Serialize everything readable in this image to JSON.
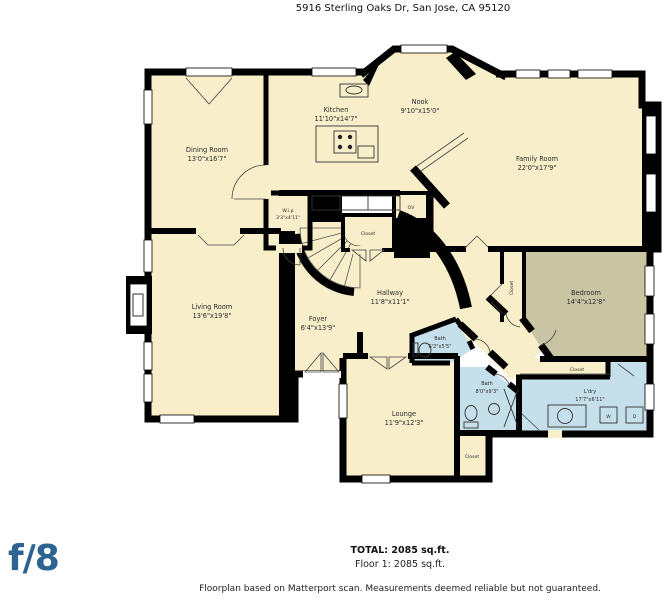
{
  "title": "5916 Sterling Oaks Dr, San Jose, CA 95120",
  "logo_text": "f/8",
  "summary": {
    "total": "TOTAL: 2085 sq.ft.",
    "floor": "Floor 1: 2085 sq.ft."
  },
  "disclaimer": "Floorplan based on Matterport scan. Measurements deemed reliable but not guaranteed.",
  "colors": {
    "room_fill": "#f8efca",
    "bedroom_fill": "#c9c4a4",
    "bath_fill": "#c6e0eb",
    "wall": "#000000",
    "logo_blue": "#2d6390"
  },
  "rooms": {
    "kitchen": {
      "name": "Kitchen",
      "dims": "11'10\"x14'7\""
    },
    "nook": {
      "name": "Nook",
      "dims": "9'10\"x15'0\""
    },
    "dining_room": {
      "name": "Dining Room",
      "dims": "13'0\"x16'7\""
    },
    "family_room": {
      "name": "Family Room",
      "dims": "22'0\"x17'9\""
    },
    "living_room": {
      "name": "Living Room",
      "dims": "13'6\"x19'8\""
    },
    "hallway": {
      "name": "Hallway",
      "dims": "11'8\"x11'1\""
    },
    "foyer": {
      "name": "Foyer",
      "dims": "6'4\"x13'9\""
    },
    "bedroom": {
      "name": "Bedroom",
      "dims": "14'4\"x12'8\""
    },
    "bath_small": {
      "name": "Bath",
      "dims": "6'2\"x5'5\""
    },
    "bath": {
      "name": "Bath",
      "dims": "8'0\"x9'3\""
    },
    "laundry": {
      "name": "L'dry",
      "dims": "17'7\"x6'11\""
    },
    "lounge": {
      "name": "Lounge",
      "dims": "11'9\"x12'3\""
    },
    "pantry": {
      "name": "W.i.p",
      "dims": "3'3\"x4'11\""
    }
  },
  "fixtures": {
    "oven": "OV",
    "closet": "Closet",
    "washer": "W",
    "dryer": "D"
  }
}
